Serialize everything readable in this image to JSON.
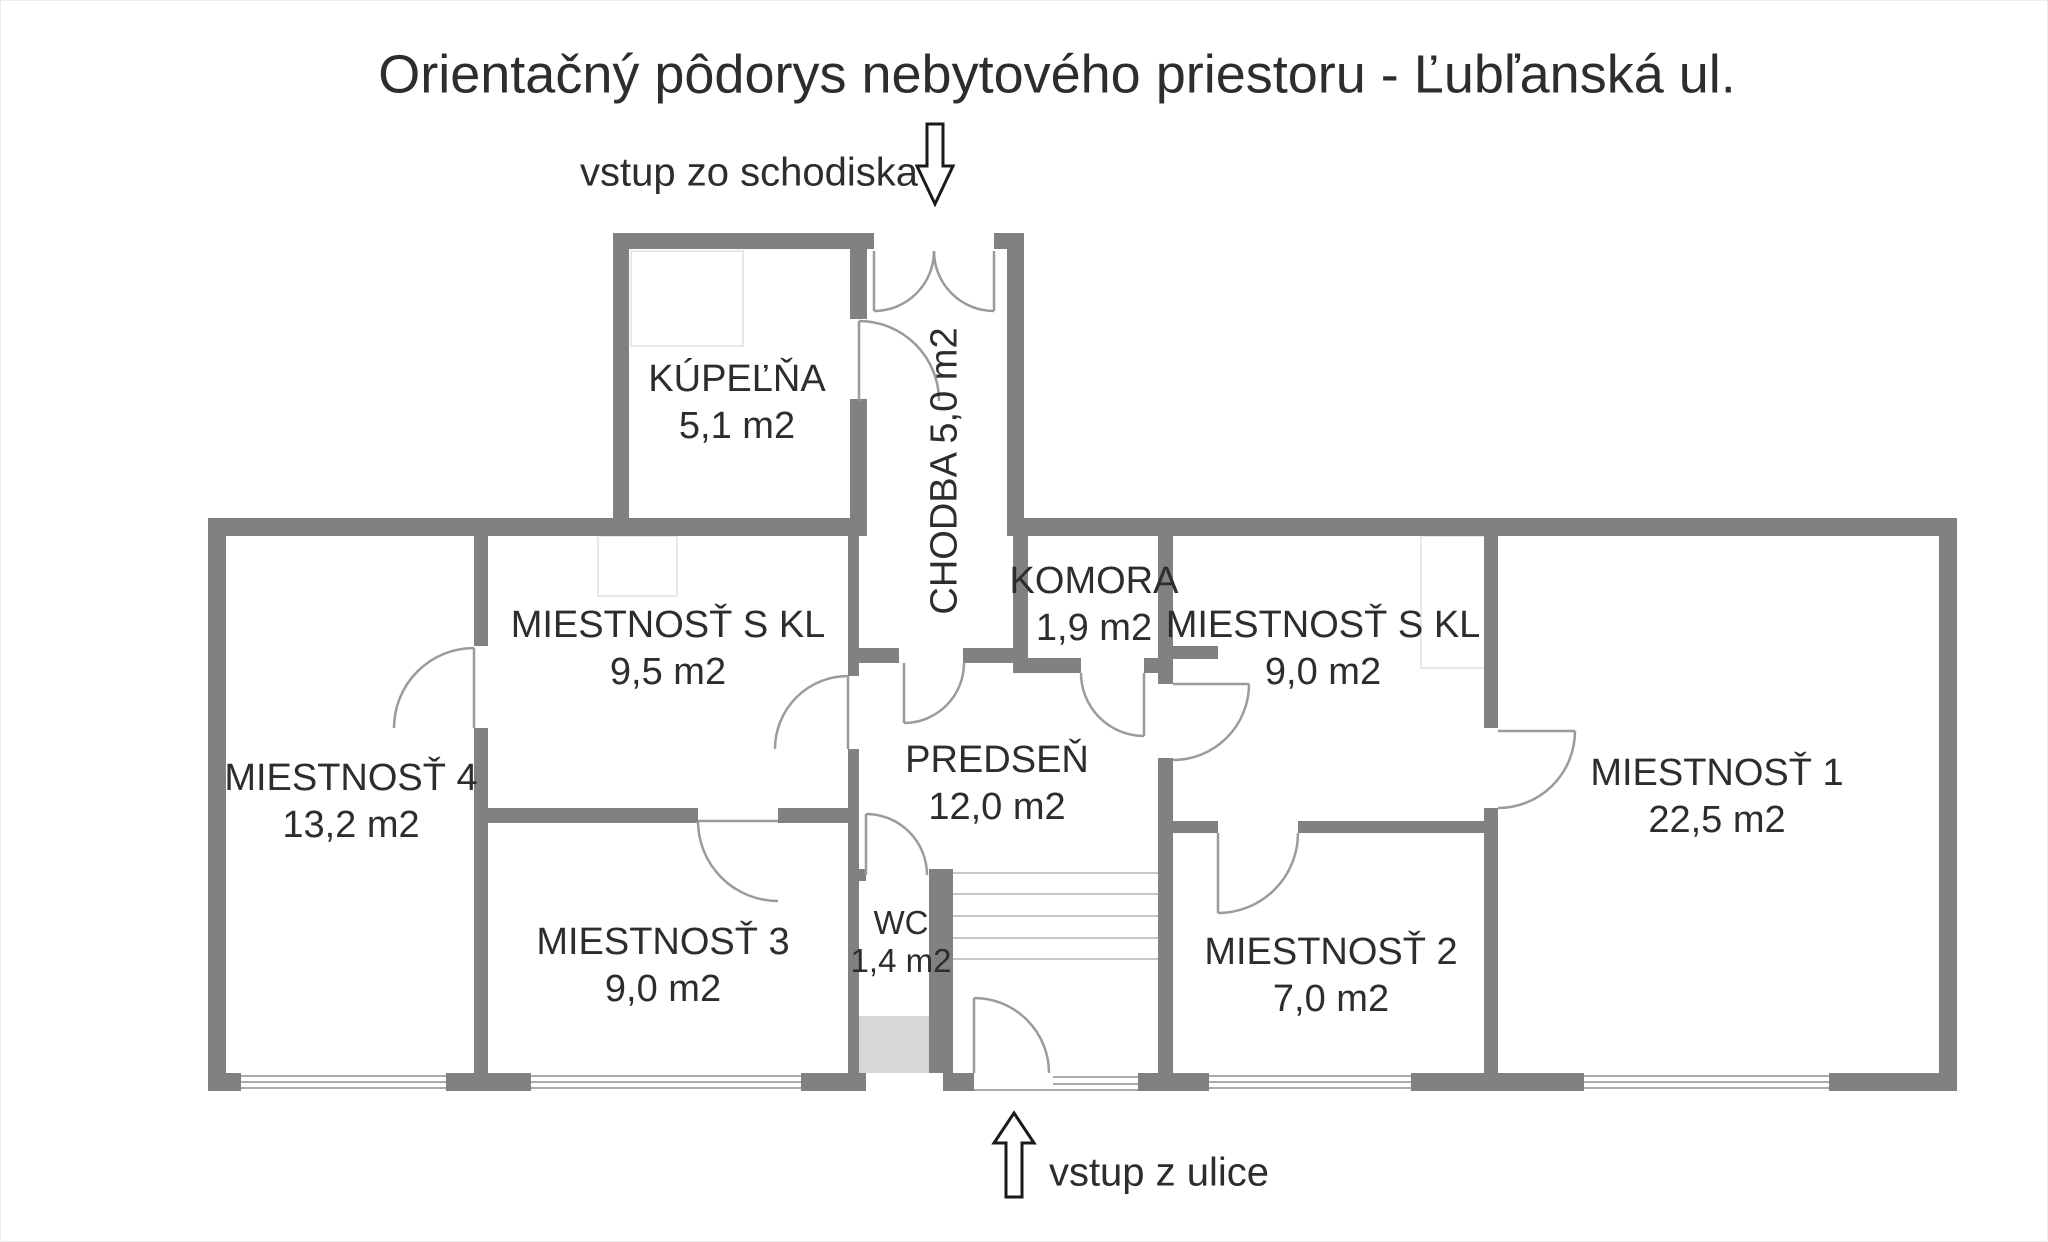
{
  "title": "Orientačný pôdorys nebytového priestoru - Ľubľanská ul.",
  "entrances": {
    "top_label": "vstup zo schodiska",
    "bottom_label": "vstup z ulice"
  },
  "rooms": {
    "kupelna": {
      "name": "KÚPEĽŇA",
      "area": "5,1 m2"
    },
    "chodba": {
      "name": "CHODBA",
      "area": "5,0 m2",
      "label": "CHODBA 5,0 m2"
    },
    "komora": {
      "name": "KOMORA",
      "area": "1,9 m2"
    },
    "kl95": {
      "name": "MIESTNOSŤ S KL",
      "area": "9,5 m2"
    },
    "kl90": {
      "name": "MIESTNOSŤ S KL",
      "area": "9,0 m2"
    },
    "m4": {
      "name": "MIESTNOSŤ 4",
      "area": "13,2 m2"
    },
    "predsen": {
      "name": "PREDSEŇ",
      "area": "12,0 m2"
    },
    "wc": {
      "name": "WC",
      "area": "1,4 m2"
    },
    "m3": {
      "name": "MIESTNOSŤ 3",
      "area": "9,0 m2"
    },
    "m2": {
      "name": "MIESTNOSŤ 2",
      "area": "7,0 m2"
    },
    "m1": {
      "name": "MIESTNOSŤ 1",
      "area": "22,5 m2"
    }
  },
  "colors": {
    "wall": "#818181",
    "door_line": "#9b9b9b",
    "window_line": "#ababab",
    "stair_line": "#c6c6c6",
    "understair_fill": "#d8d8d8",
    "text": "#2d2d2d",
    "arrow_outline": "#1a1a1a",
    "background": "#ffffff"
  }
}
